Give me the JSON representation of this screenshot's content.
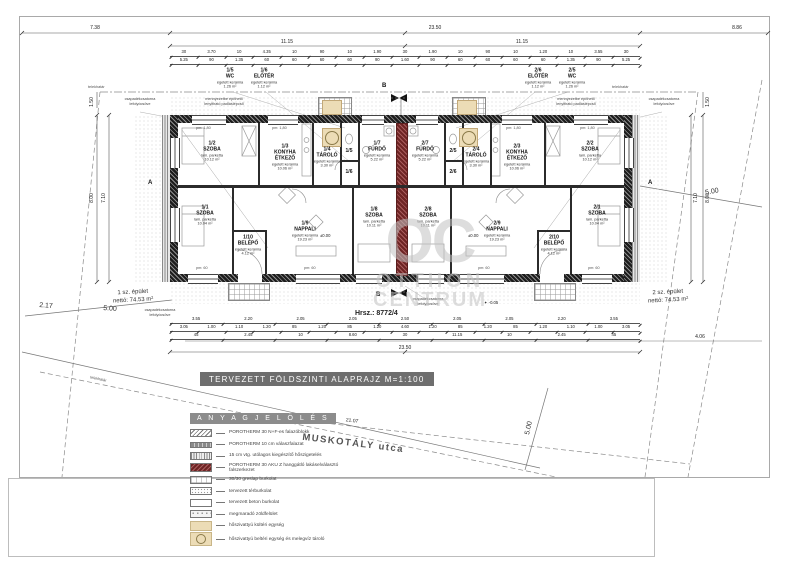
{
  "meta": {
    "sheet_title": "TERVEZETT  FÖLDSZINTI  ALAPRAJZ   M=1:100",
    "hrsz": "Hrsz.: 8772/4"
  },
  "watermark": {
    "oc": "OC",
    "line1": "OTTHON",
    "line2": "CENTRUM"
  },
  "street": {
    "name": "MUSKOTÁLY  utca",
    "length": "21.07"
  },
  "buildings": {
    "left": {
      "name": "1 sz. épület",
      "net": "nettó: 74.53 m²"
    },
    "right": {
      "name": "2 sz. épület",
      "net": "nettó: 74.53 m²"
    }
  },
  "rooms": [
    {
      "num": "1/1",
      "name": "SZOBA",
      "mat": "lam. parketta",
      "area": "10.04 m²"
    },
    {
      "num": "1/2",
      "name": "SZOBA",
      "mat": "lam. parketta",
      "area": "10.12 m²"
    },
    {
      "num": "1/3",
      "name": "KONYHA ÉTKEZŐ",
      "mat": "égetett kerámia",
      "area": "10.06 m²"
    },
    {
      "num": "1/4",
      "name": "TÁROLÓ",
      "mat": "égetett kerámia",
      "area": "3.30 m²"
    },
    {
      "num": "1/5",
      "name": "WC",
      "mat": "égetett kerámia",
      "area": "1.26 m²"
    },
    {
      "num": "1/6",
      "name": "ELŐTÉR",
      "mat": "égetett kerámia",
      "area": "1.12 m²"
    },
    {
      "num": "1/7",
      "name": "FÜRDŐ",
      "mat": "égetett kerámia",
      "area": "5.22 m²"
    },
    {
      "num": "1/8",
      "name": "SZOBA",
      "mat": "lam. parketta",
      "area": "10.11 m²"
    },
    {
      "num": "1/9",
      "name": "NAPPALI",
      "mat": "égetett kerámia",
      "area": "19.23 m²"
    },
    {
      "num": "1/10",
      "name": "BELÉPŐ",
      "mat": "égetett kerámia",
      "area": "4.12 m²"
    },
    {
      "num": "2/1",
      "name": "SZOBA",
      "mat": "lam. parketta",
      "area": "10.04 m²"
    },
    {
      "num": "2/2",
      "name": "SZOBA",
      "mat": "lam. parketta",
      "area": "10.12 m²"
    },
    {
      "num": "2/3",
      "name": "KONYHA ÉTKEZŐ",
      "mat": "égetett kerámia",
      "area": "10.06 m²"
    },
    {
      "num": "2/4",
      "name": "TÁROLÓ",
      "mat": "égetett kerámia",
      "area": "3.30 m²"
    },
    {
      "num": "2/5",
      "name": "WC",
      "mat": "égetett kerámia",
      "area": "1.26 m²"
    },
    {
      "num": "2/6",
      "name": "ELŐTÉR",
      "mat": "égetett kerámia",
      "area": "1.12 m²"
    },
    {
      "num": "2/7",
      "name": "FÜRDŐ",
      "mat": "égetett kerámia",
      "area": "5.22 m²"
    },
    {
      "num": "2/8",
      "name": "SZOBA",
      "mat": "lam. parketta",
      "area": "10.11 m²"
    },
    {
      "num": "2/9",
      "name": "NAPPALI",
      "mat": "égetett kerámia",
      "area": "19.23 m²"
    },
    {
      "num": "2/10",
      "name": "BELÉPŐ",
      "mat": "égetett kerámia",
      "area": "4.12 m²"
    }
  ],
  "notes": {
    "attic": "mennyezetbe építhető lenyitható padláslépcső",
    "downpipe": "csapadékcsatorna lefolyócsöve",
    "boundary": "telekhatár"
  },
  "levels": {
    "zero": "±0.00",
    "minus": "✦ -0.05"
  },
  "window_labels": {
    "top": "pm: 1,80",
    "bottom": "pm: 60"
  },
  "section": {
    "a": "A",
    "b": "B"
  },
  "dims": {
    "top_total_left": "7.38",
    "top_total_mid": "23.50",
    "top_total_right": "8.86",
    "top_1115_left": "11.15",
    "top_1115_right": "11.15",
    "bottom_total": "23.50",
    "bottom_right_ext": "4.06",
    "left_v1": "8.00",
    "left_v2": "7.10",
    "left_v3": "1.50",
    "right_v1": "7.10",
    "right_v2": "8.00",
    "right_v3": "1.50",
    "front_left": "2.17",
    "side_left": "5.00",
    "side_right": "5.00",
    "front_mid": "5.00",
    "chains": {
      "top_a": [
        "30",
        "3.70",
        "10",
        "4.35",
        "10",
        "90",
        "10",
        "1.90",
        "30",
        "1.90",
        "10",
        "90",
        "10",
        "1.20",
        "10",
        "3.55",
        "30"
      ],
      "top_b": [
        "5.25",
        "90",
        "1.35",
        "60",
        "60",
        "60",
        "60",
        "90",
        "1.60",
        "90",
        "60",
        "60",
        "60",
        "60",
        "1.35",
        "90",
        "5.25"
      ],
      "bottom_a": [
        "3.55",
        "2.20",
        "2.05",
        "2.05",
        "2.50",
        "2.05",
        "2.05",
        "2.20",
        "3.55"
      ],
      "bottom_b": [
        "3.05",
        "1.00",
        "1.10",
        "1.20",
        "85",
        "1.20",
        "85",
        "1.20",
        "4.60",
        "1.20",
        "85",
        "1.20",
        "85",
        "1.20",
        "1.10",
        "1.00",
        "3.05"
      ],
      "bottom_c": [
        "45",
        "2.45",
        "10",
        "8.60",
        "30",
        "11.15",
        "10",
        "2.45",
        "45"
      ]
    }
  },
  "legend": {
    "header": "A N Y A G J E L Ö L É S",
    "items": [
      {
        "label": "POROTHERM 30 N+F-es  falazóblokk"
      },
      {
        "label": "POROTHERM 10 cm válaszfalazat"
      },
      {
        "label": "15 cm vtg. utólagos kiegészítő hőszigetelés"
      },
      {
        "label": "POROTHERM 30 AKU Z hanggátló lakáselválasztó falszerkezet"
      },
      {
        "label": "30/30 greslap  burkolat"
      },
      {
        "label": "tervezett térburkolat"
      },
      {
        "label": "tervezett beton burkolat"
      },
      {
        "label": "megmaradó zöldfelület"
      },
      {
        "label": "hőszivattyú kültéri egység"
      },
      {
        "label": "hőszivattyú beltéri egység és melegvíz tároló"
      }
    ]
  },
  "colors": {
    "party_wall": "#7b3030",
    "heat_pump": "#ecdcb6",
    "watermark": "#c2c2c2",
    "title_bg": "#6e6e6e"
  }
}
